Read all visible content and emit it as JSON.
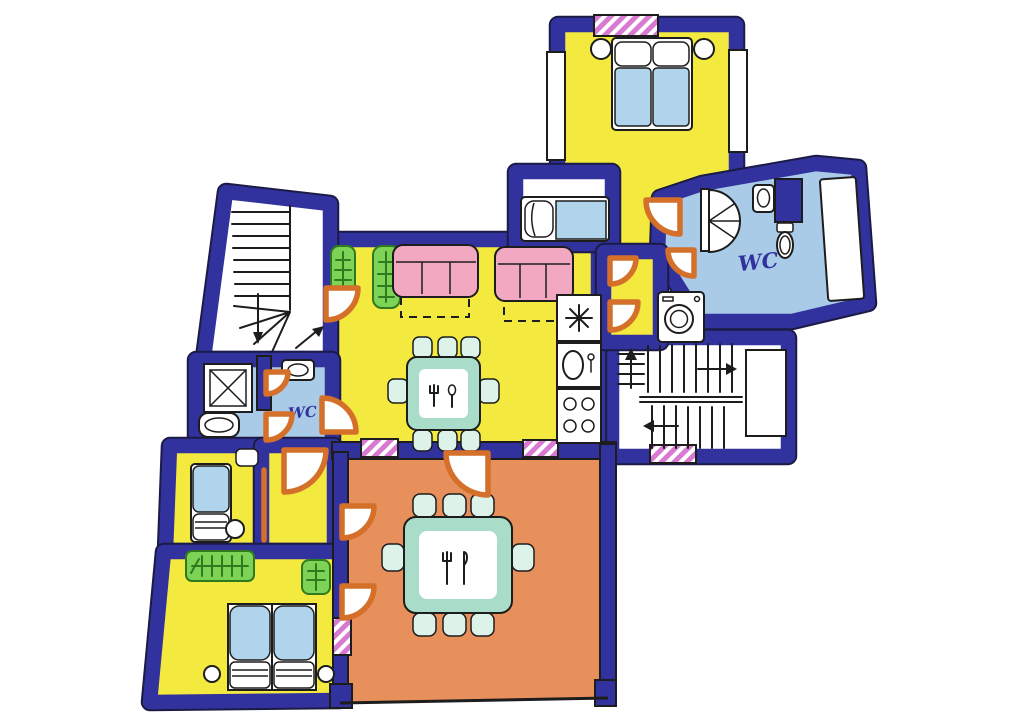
{
  "title": "Hand-drawn apartment floor plan",
  "labels": {
    "wc_main": "WC",
    "wc_secondary": "WC"
  },
  "colors": {
    "wall": "#32329e",
    "outline": "#1b1b45",
    "yellow": "#f3e93f",
    "orange": "#e8905c",
    "bathblue": "#a9cbe7",
    "pink": "#f2a8c0",
    "green": "#7dd356",
    "greendark": "#2e7a1d",
    "teal": "#a9dcc9",
    "tealight": "#ddf2e9",
    "bedblue": "#b0d4ec",
    "door": "#d4702a",
    "hatch": "#d879d2",
    "ink": "#1d1d1d",
    "paper": "#ffffff"
  },
  "icons": {
    "shower": "quarter-disc stall with spokes",
    "toilet": "oval pan",
    "sink": "oval basin in box",
    "bathtub": "rounded tub with oval",
    "washing_machine": "box with drum circle",
    "stove": "box with four burner rings",
    "extractor_fan": "asterisk in box",
    "cutlery": "fork and knife on table",
    "plant": "green box with fir branch",
    "radiator": "green ribbed strip",
    "staircase": "treads with direction arrows",
    "bed": "pillow and blue duvet",
    "sofa": "pink three-cushion seat with dashed pull-out",
    "entrance_marker": "pink diagonal-striped wall block"
  }
}
